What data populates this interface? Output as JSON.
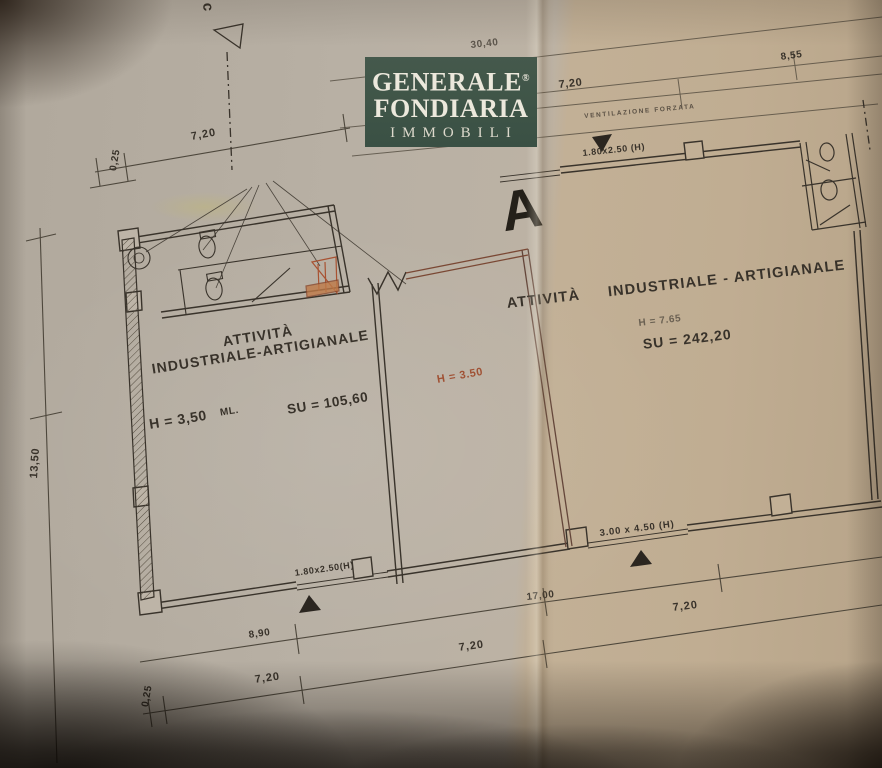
{
  "palette": {
    "paper_left": "#b8b0a4",
    "paper_right": "#c0ad92",
    "ink": "#39332b",
    "sepia_ink": "#7a4834",
    "stair_orange": "#bf7a48",
    "logo_green": "#3f574a"
  },
  "logo": {
    "brand_line1": "GENERALE",
    "registered": "®",
    "brand_line2": "FONDIARIA",
    "brand_line3": "IMMOBILI"
  },
  "markers": {
    "section_c": "c",
    "section_a": "A"
  },
  "annotations": {
    "ventilation": "VENTILAZIONE FORZATA",
    "door_top": "1.80x2.50 (H)",
    "door_bottom_left": "1.80x2.50(H)",
    "door_bottom_right": "3.00 x 4.50 (H)"
  },
  "rooms": {
    "left": {
      "title_line1": "ATTIVITÀ",
      "title_line2": "INDUSTRIALE-ARTIGIANALE",
      "height": "H = 3,50",
      "height_unit": "ML.",
      "surface": "SU = 105,60"
    },
    "middle": {
      "height": "H = 3.50"
    },
    "right": {
      "title_line1": "ATTIVITÀ",
      "title_line2": "INDUSTRIALE - ARTIGIANALE",
      "height": "H = 7.65",
      "surface": "SU = 242,20"
    }
  },
  "dimensions": {
    "top_total": "30,40",
    "top_right": "8,55",
    "top_mid": "7,20",
    "upper_left": "7,20",
    "upper_left_offset": "0,25",
    "left_height": "13,50",
    "bottom_total": "17,00",
    "bottom_left": "8,90",
    "bottom_mid": "7,20",
    "bottom_right": "7,20",
    "lower_left": "7,20",
    "lower_left_offset": "0,25"
  }
}
